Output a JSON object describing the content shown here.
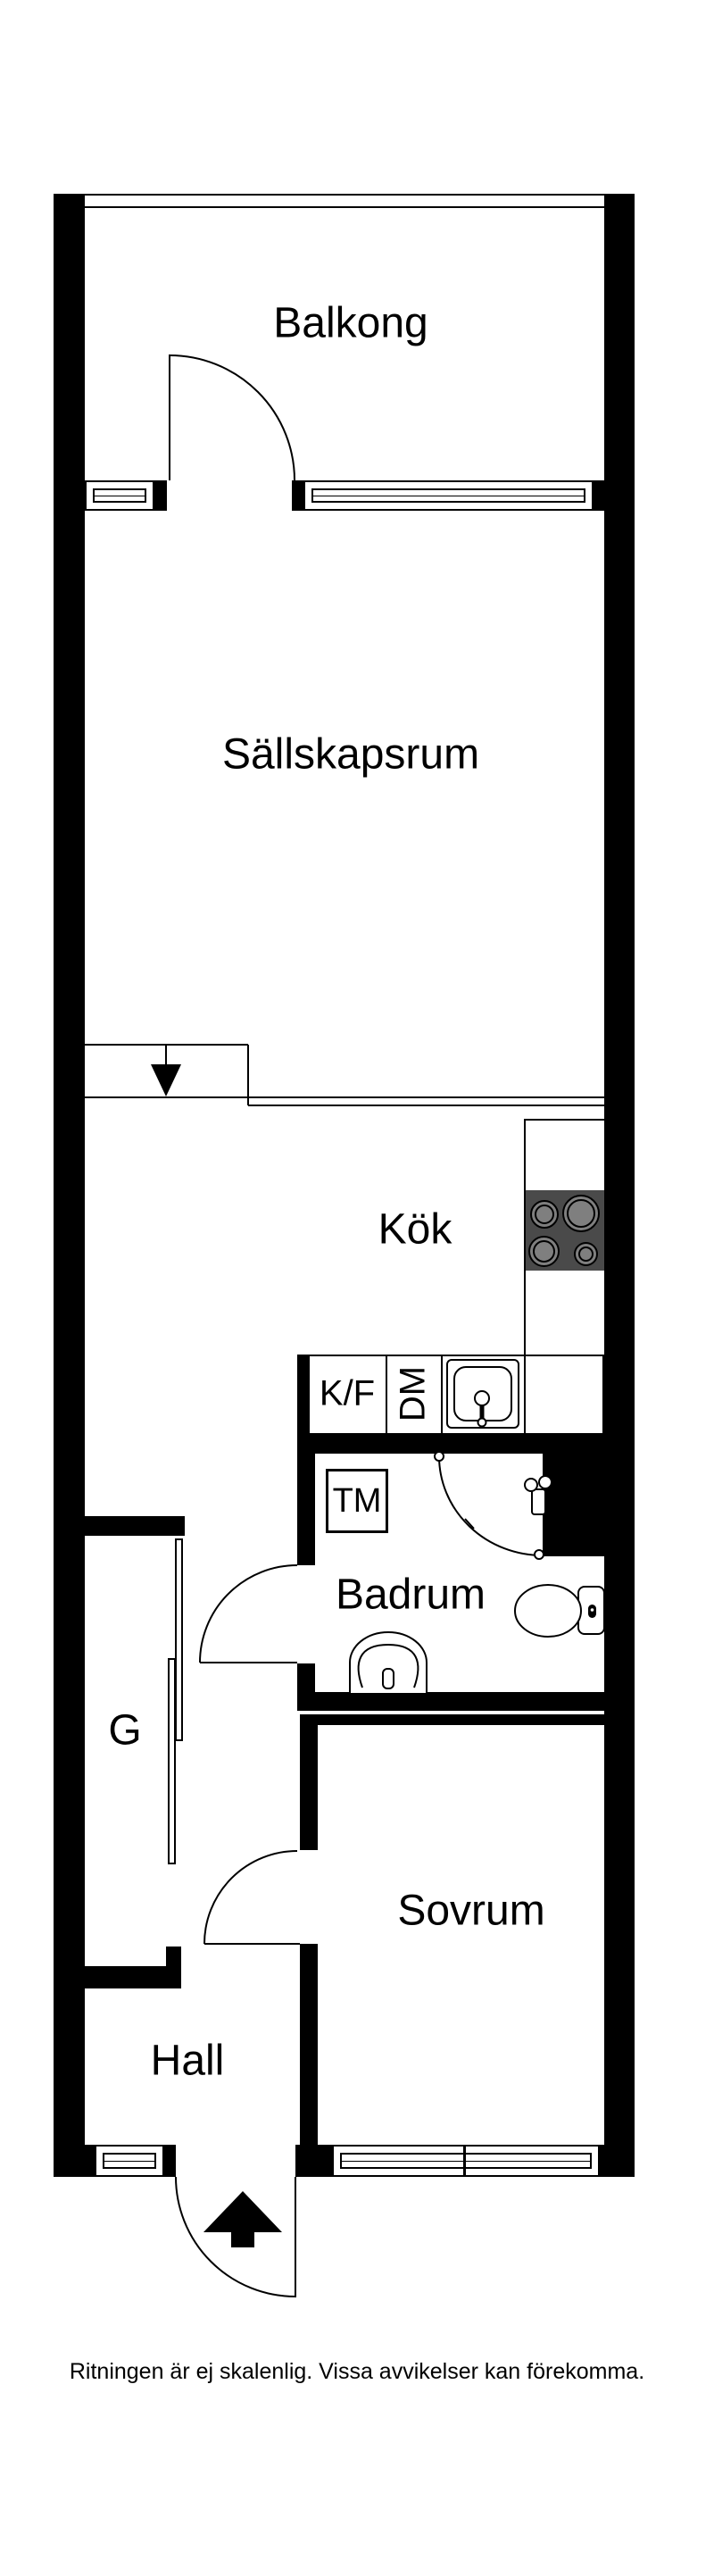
{
  "document": {
    "type": "floor-plan",
    "footer_disclaimer": "Ritningen är ej skalenlig. Vissa avvikelser kan förekomma."
  },
  "rooms": {
    "balkong": {
      "label": "Balkong"
    },
    "sallskapsrum": {
      "label": "Sällskapsrum"
    },
    "kok": {
      "label": "Kök"
    },
    "badrum": {
      "label": "Badrum"
    },
    "garderob": {
      "label": "G"
    },
    "sovrum": {
      "label": "Sovrum"
    },
    "hall": {
      "label": "Hall"
    }
  },
  "fixtures": {
    "fridge_freezer": {
      "label": "K/F"
    },
    "dishwasher": {
      "label": "DM"
    },
    "washing_machine": {
      "label": "TM"
    }
  },
  "colors": {
    "wall": "#000000",
    "line": "#000000",
    "stove_body": "#4a4a4a",
    "burner_fill": "#7f7f7f",
    "background": "#ffffff"
  }
}
